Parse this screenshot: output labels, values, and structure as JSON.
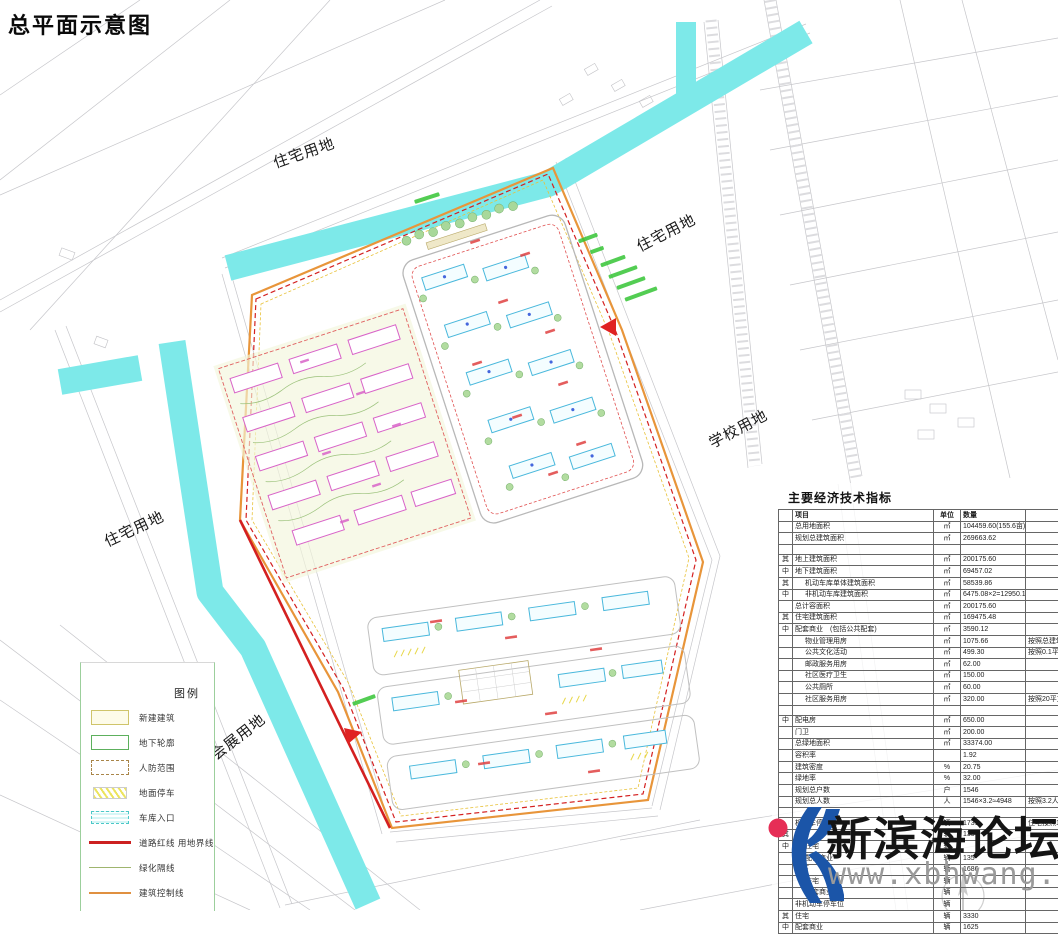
{
  "title": "总平面示意图",
  "colors": {
    "canal_cyan": "#7de9e9",
    "boundary_red": "#d42020",
    "control_orange": "#e8953a",
    "building_pink": "#d863c8",
    "building_cyan": "#49b8dc",
    "tree_green": "#8cc47c",
    "annotation_green": "#35c435",
    "watermark_blue": "#1b55a8",
    "watermark_red": "#e62e56",
    "faint_line": "#c6c6ca"
  },
  "land_labels": [
    {
      "text": "住宅用地"
    },
    {
      "text": "住宅用地"
    },
    {
      "text": "学校用地"
    },
    {
      "text": "住宅用地"
    },
    {
      "text": "会展用地"
    }
  ],
  "legend": {
    "title": "图例",
    "items": [
      {
        "label": "新建建筑",
        "swatch": "new-building"
      },
      {
        "label": "地下轮廓",
        "swatch": "underground"
      },
      {
        "label": "人防范围",
        "swatch": "civil-defense"
      },
      {
        "label": "地面停车",
        "swatch": "surface-parking"
      },
      {
        "label": "车库入口",
        "swatch": "garage-entry"
      },
      {
        "label": "道路红线 用地界线",
        "swatch": "road-redline"
      },
      {
        "label": "绿化隔线",
        "swatch": "green-line"
      },
      {
        "label": "建筑控制线",
        "swatch": "control-line"
      }
    ]
  },
  "indicators": {
    "title": "主要经济技术指标",
    "headers": {
      "item": "项目",
      "unit": "单位",
      "qty": "数量"
    },
    "rows": [
      {
        "label": "总用地面积",
        "unit": "㎡",
        "value": "104459.60(155.6亩)"
      },
      {
        "label": "规划总建筑面积",
        "unit": "㎡",
        "value": "269663.62"
      },
      {
        "spacer": true
      },
      {
        "g": "其",
        "label": "地上建筑面积",
        "unit": "㎡",
        "value": "200175.60"
      },
      {
        "g": "中",
        "label": "地下建筑面积",
        "unit": "㎡",
        "value": "69457.02"
      },
      {
        "g": "其",
        "indent": 1,
        "label": "机动车库单体建筑面积",
        "unit": "㎡",
        "value": "58539.86"
      },
      {
        "g": "中",
        "indent": 1,
        "label": "非机动车库建筑面积",
        "unit": "㎡",
        "value": "6475.08×2=12950.16"
      },
      {
        "label": "总计容面积",
        "unit": "㎡",
        "value": "200175.60"
      },
      {
        "g": "其",
        "label": "住宅建筑面积",
        "unit": "㎡",
        "value": "169475.48"
      },
      {
        "g": "中",
        "label": "配套商业　(包括公共配套)",
        "unit": "㎡",
        "value": "3590.12"
      },
      {
        "indent": 1,
        "label": "物业管理用房",
        "unit": "㎡",
        "value": "1075.66",
        "note": "按照总建筑面积4%计算"
      },
      {
        "indent": 1,
        "label": "公共文化活动",
        "unit": "㎡",
        "value": "499.30",
        "note": "按照0.1平方米/人计算"
      },
      {
        "indent": 1,
        "label": "邮政服务用房",
        "unit": "㎡",
        "value": "62.00"
      },
      {
        "indent": 1,
        "label": "社区医疗卫生",
        "unit": "㎡",
        "value": "150.00"
      },
      {
        "indent": 1,
        "label": "公共厕所",
        "unit": "㎡",
        "value": "60.00"
      },
      {
        "indent": 1,
        "label": "社区服务用房",
        "unit": "㎡",
        "value": "320.00",
        "note": "按照20平方米/100户计算"
      },
      {
        "spacer": true
      },
      {
        "g": "中",
        "label": "配电房",
        "unit": "㎡",
        "value": "650.00"
      },
      {
        "label": "门卫",
        "unit": "㎡",
        "value": "200.00"
      },
      {
        "label": "总绿地面积",
        "unit": "㎡",
        "value": "33374.00"
      },
      {
        "label": "容积率",
        "unit": "",
        "value": "1.92"
      },
      {
        "label": "建筑密度",
        "unit": "%",
        "value": "20.75"
      },
      {
        "label": "绿地率",
        "unit": "%",
        "value": "32.00"
      },
      {
        "label": "规划总户数",
        "unit": "户",
        "value": "1546"
      },
      {
        "label": "规划总人数",
        "unit": "人",
        "value": "1546×3.2≈4948",
        "note": "按照3.2人/户计算"
      },
      {
        "spacer": true
      },
      {
        "label": "机动车停车位",
        "unit": "辆",
        "value": "1731",
        "note": "住宅按照1.0辆/100平方米计算\n商业按照0.8辆/100平方米计算"
      },
      {
        "g": "其",
        "label": "地上",
        "unit": "辆",
        "value": "135"
      },
      {
        "g": "中",
        "indent": 1,
        "label": "住宅",
        "unit": "辆",
        "value": ""
      },
      {
        "indent": 1,
        "label": "配套商业",
        "unit": "辆",
        "value": "135"
      },
      {
        "label": "地下",
        "unit": "辆",
        "value": "1686"
      },
      {
        "indent": 1,
        "label": "住宅",
        "unit": "辆",
        "value": ""
      },
      {
        "indent": 1,
        "label": "配套商业",
        "unit": "辆",
        "value": ""
      },
      {
        "label": "非机动车停车位",
        "unit": "辆",
        "value": ""
      },
      {
        "g": "其",
        "label": "住宅",
        "unit": "辆",
        "value": "3330"
      },
      {
        "g": "中",
        "label": "配套商业",
        "unit": "辆",
        "value": "1625"
      }
    ]
  },
  "watermark": {
    "site_name": "新滨海论坛",
    "url": "www.xbhwang.com"
  }
}
